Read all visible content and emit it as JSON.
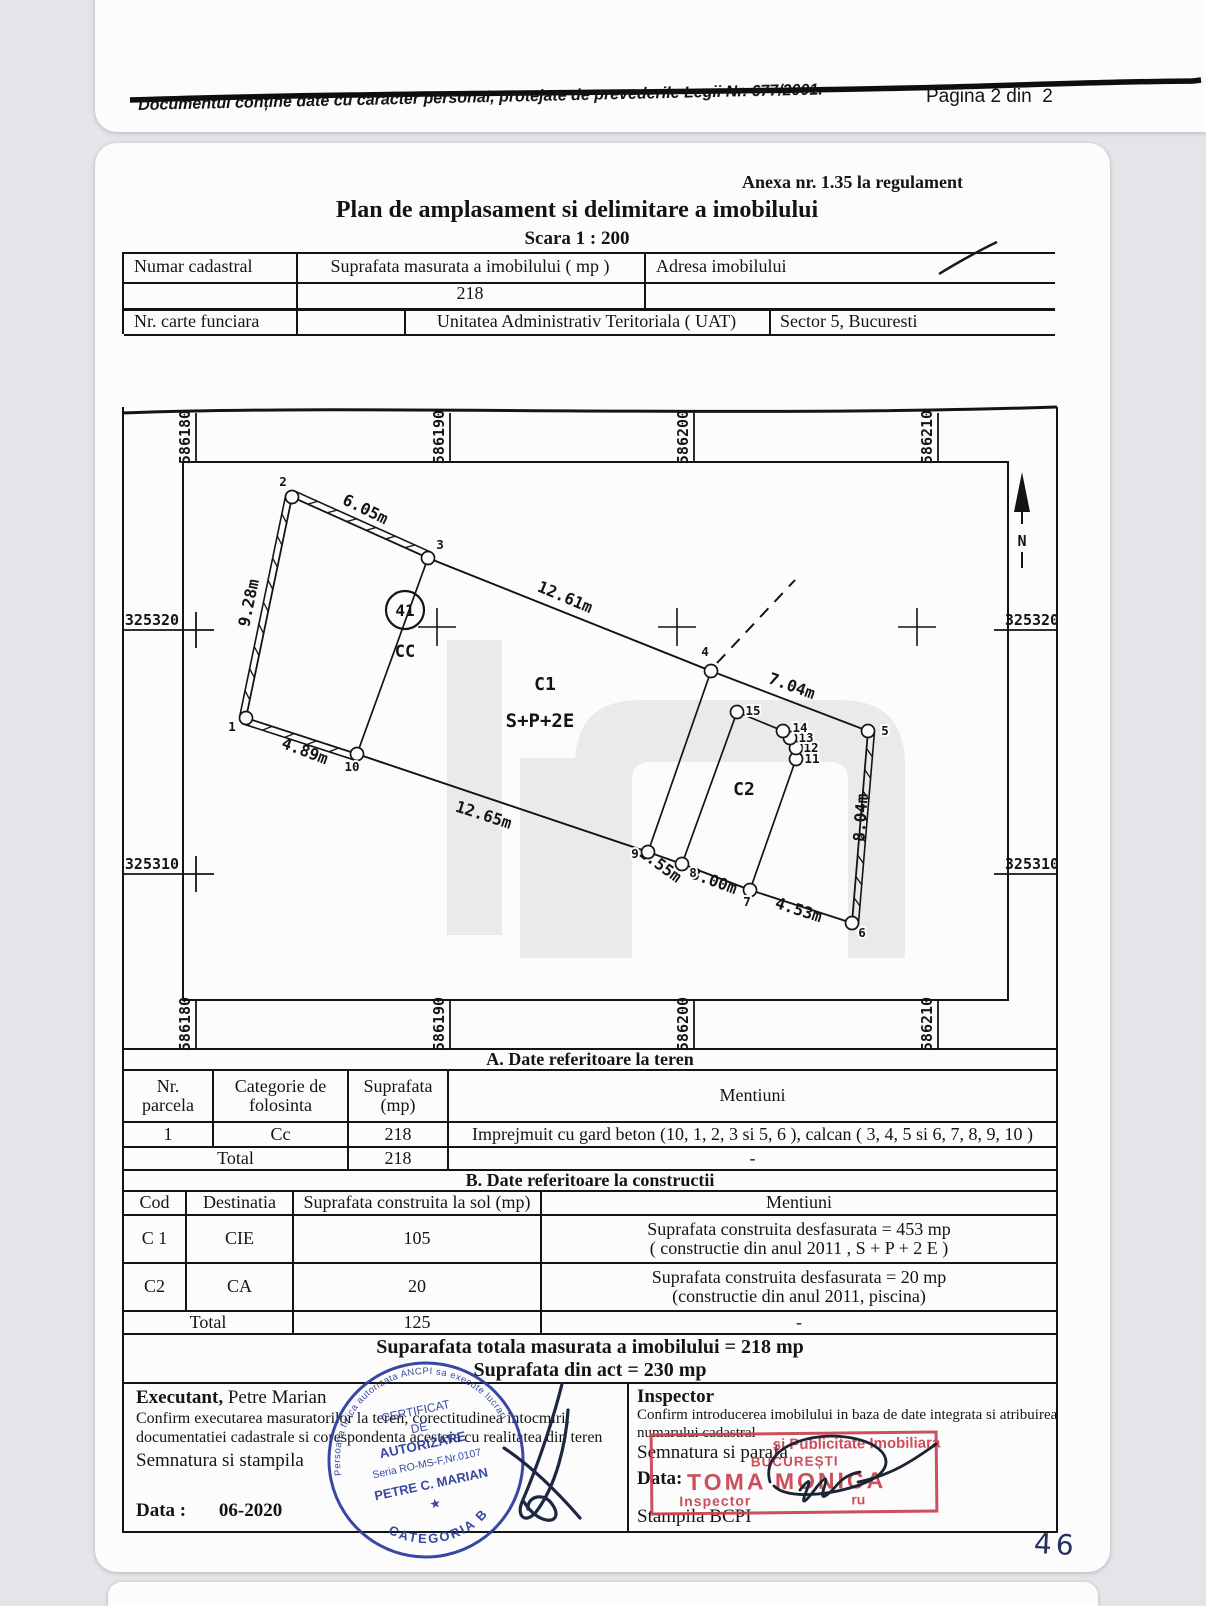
{
  "header": {
    "disclaimer": "Documentul conține date cu caracter personal, protejate de prevederile Legii Nr. 677/2001.",
    "page": "Pagina 2 din  2",
    "annex": "Anexa nr. 1.35 la regulament",
    "title": "Plan de amplasament si delimitare a imobilului",
    "scale": "Scara 1 : 200"
  },
  "id_table": {
    "cadastral_label": "Numar cadastral",
    "area_label": "Suprafata masurata a imobilului ( mp )",
    "address_label": "Adresa imobilului",
    "area_value": "218",
    "land_book_label": "Nr. carte funciara",
    "uat_label": "Unitatea Administrativ Teritoriala ( UAT)",
    "uat_value": "Sector 5, Bucuresti"
  },
  "drawing": {
    "grid_x": [
      {
        "x": 196,
        "t": "586180"
      },
      {
        "x": 450,
        "t": "586190"
      },
      {
        "x": 694,
        "t": "586200"
      },
      {
        "x": 938,
        "t": "586210"
      }
    ],
    "grid_y": [
      {
        "y": 630,
        "t": "325320"
      },
      {
        "y": 874,
        "t": "325310"
      }
    ],
    "crosses": [
      [
        437,
        627
      ],
      [
        677,
        627
      ],
      [
        917,
        627
      ]
    ],
    "north": {
      "x": 1022,
      "label": "N"
    },
    "dashed": [
      717,
      663,
      795,
      580
    ],
    "parcel": [
      "1",
      "2",
      "3",
      "4",
      "5",
      "6",
      "7",
      "8",
      "9",
      "10"
    ],
    "fence": [
      [
        "10",
        "1"
      ],
      [
        "1",
        "2"
      ],
      [
        "2",
        "3"
      ],
      [
        "5",
        "6"
      ]
    ],
    "c1": [
      "3",
      "4",
      "9",
      "10"
    ],
    "c2": [
      "15",
      "14",
      "13",
      "12",
      "11",
      "7",
      "8"
    ],
    "badge": {
      "x": 405,
      "y": 610,
      "t": "41"
    },
    "labels": [
      {
        "t": "CC",
        "x": 405,
        "y": 657,
        "fs": 17
      },
      {
        "t": "C1",
        "x": 545,
        "y": 690,
        "fs": 18
      },
      {
        "t": "S+P+2E",
        "x": 540,
        "y": 727,
        "fs": 19
      },
      {
        "t": "C2",
        "x": 744,
        "y": 795,
        "fs": 18
      }
    ],
    "dims": [
      {
        "t": "6.05m",
        "x": 363,
        "y": 514,
        "r": 26
      },
      {
        "t": "9.28m",
        "x": 254,
        "y": 604,
        "r": -78
      },
      {
        "t": "4.89m",
        "x": 303,
        "y": 756,
        "r": 21
      },
      {
        "t": "12.61m",
        "x": 563,
        "y": 602,
        "r": 23
      },
      {
        "t": "7.04m",
        "x": 790,
        "y": 691,
        "r": 20
      },
      {
        "t": "8.04m",
        "x": 866,
        "y": 818,
        "r": -86
      },
      {
        "t": "12.65m",
        "x": 482,
        "y": 820,
        "r": 18
      },
      {
        "t": "1.55m",
        "x": 657,
        "y": 869,
        "r": 36
      },
      {
        "t": "3.00m",
        "x": 712,
        "y": 886,
        "r": 20
      },
      {
        "t": "4.53m",
        "x": 797,
        "y": 915,
        "r": 18
      }
    ],
    "points": {
      "1": {
        "x": 246,
        "y": 718,
        "lx": 232,
        "ly": 731
      },
      "2": {
        "x": 292,
        "y": 497,
        "lx": 283,
        "ly": 486
      },
      "3": {
        "x": 428,
        "y": 558,
        "lx": 440,
        "ly": 549
      },
      "4": {
        "x": 711,
        "y": 671,
        "lx": 705,
        "ly": 656
      },
      "5": {
        "x": 868,
        "y": 731,
        "lx": 885,
        "ly": 735
      },
      "6": {
        "x": 852,
        "y": 923,
        "lx": 862,
        "ly": 937
      },
      "7": {
        "x": 750,
        "y": 890,
        "lx": 747,
        "ly": 906
      },
      "8": {
        "x": 682,
        "y": 864,
        "lx": 693,
        "ly": 877
      },
      "9": {
        "x": 648,
        "y": 852,
        "lx": 635,
        "ly": 858
      },
      "10": {
        "x": 357,
        "y": 754,
        "lx": 352,
        "ly": 771
      },
      "11": {
        "x": 796,
        "y": 759,
        "lx": 812,
        "ly": 763
      },
      "12": {
        "x": 796,
        "y": 748,
        "lx": 811,
        "ly": 752
      },
      "13": {
        "x": 790,
        "y": 738,
        "lx": 806,
        "ly": 742
      },
      "14": {
        "x": 783,
        "y": 731,
        "lx": 800,
        "ly": 732
      },
      "15": {
        "x": 737,
        "y": 712,
        "lx": 753,
        "ly": 715
      }
    }
  },
  "table_a": {
    "title": "A. Date referitoare la teren",
    "headers": [
      "Nr.\nparcela",
      "Categorie de\nfolosinta",
      "Suprafata\n(mp)",
      "Mentiuni"
    ],
    "row": {
      "nr": "1",
      "cat": "Cc",
      "sup": "218",
      "ment": "Imprejmuit cu gard beton (10, 1, 2, 3 si 5, 6 ), calcan ( 3, 4, 5 si 6, 7, 8, 9, 10 )"
    },
    "total_label": "Total",
    "total_sup": "218",
    "total_ment": "-"
  },
  "table_b": {
    "title": "B. Date referitoare la constructii",
    "headers": [
      "Cod",
      "Destinatia",
      "Suprafata construita la sol (mp)",
      "Mentiuni"
    ],
    "rows": [
      {
        "cod": "C 1",
        "dest": "CIE",
        "sup": "105",
        "m1": "Suprafata construita desfasurata = 453 mp",
        "m2": "( constructie din anul 2011 , S + P + 2 E )"
      },
      {
        "cod": "C2",
        "dest": "CA",
        "sup": "20",
        "m1": "Suprafata construita desfasurata = 20 mp",
        "m2": "(constructie din anul 2011, piscina)"
      }
    ],
    "total_label": "Total",
    "total_sup": "125",
    "total_ment": "-"
  },
  "totals": {
    "measured": "Suparafata totala masurata a imobilului = 218 mp",
    "act": "Suprafata din act =  230 mp"
  },
  "footer": {
    "executant": {
      "title": "Executant,",
      "name": " Petre Marian",
      "line1": "Confirm executarea masuratorilor la teren, corectitudinea intocmirii",
      "line2": "documentatiei cadastrale si corespondenta acesteia cu realitatea din teren",
      "sign": "Semnatura si stampila",
      "date_label": "Data :",
      "date_value": "06-2020"
    },
    "inspector": {
      "title": "Inspector",
      "line1": "Confirm introducerea imobilului in baza de date integrata si atribuirea",
      "line2": "numarului cadastral",
      "sign": "Semnatura si parafa",
      "date_label": "Data:",
      "stamp_label": "Stampila BCPI"
    }
  },
  "stamps": {
    "blue": {
      "ring": "Persoana fizica autorizata ANCPI sa execute lucrari",
      "l1": "CERTIFICAT",
      "l2": "DE",
      "l3": "AUTORIZARE",
      "l4": "Seria RO-MS-F,Nr.0107",
      "l5": "PETRE C. MARIAN",
      "star": "★",
      "category": "CATEGORIA B"
    },
    "red": {
      "l1": "și Publicitate Imobiliara",
      "l2": "BUCUREȘTI",
      "l3": "TOMA MONICA",
      "l4": "Inspector",
      "l4b": "ru"
    }
  },
  "handwritten": "46"
}
